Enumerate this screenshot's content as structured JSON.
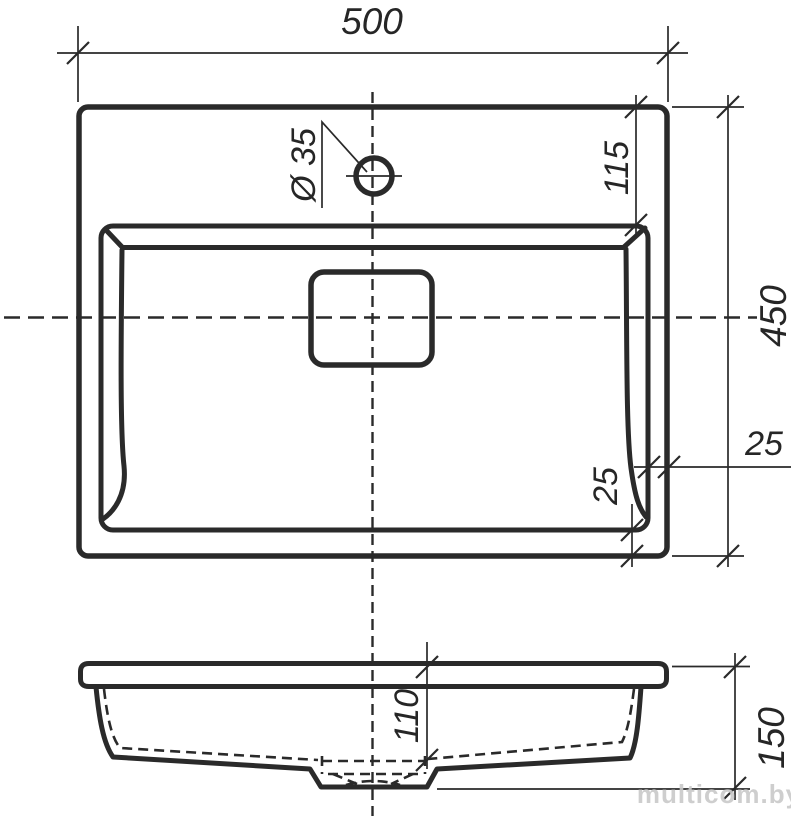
{
  "drawing": {
    "title_implicit": "washbasin technical drawing",
    "dimensions": {
      "overall_width": "500",
      "hole_to_basin_offset": "115",
      "overall_depth": "450",
      "rim_offset_right": "25",
      "rim_offset_bottom": "25",
      "faucet_hole_diameter": "Ø 35",
      "bowl_inner_depth": "110",
      "overall_height": "150"
    },
    "watermark": "multicom.by",
    "colors": {
      "line": "#2a2a2a",
      "background": "#ffffff",
      "watermark": "#c9c9c9"
    }
  }
}
